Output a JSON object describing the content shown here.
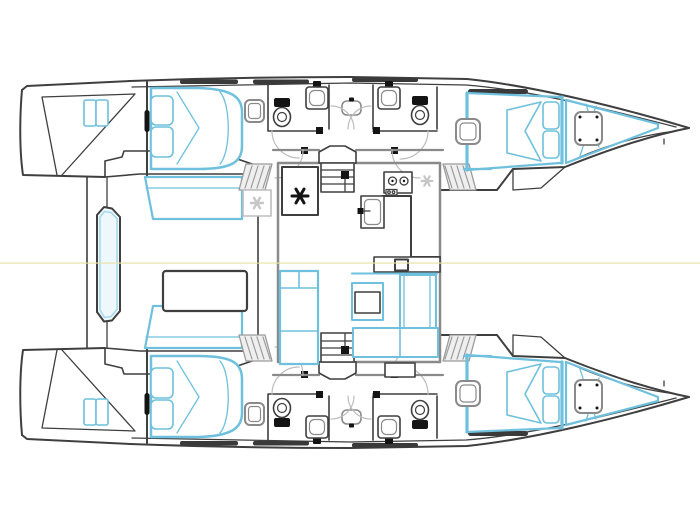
{
  "meta": {
    "title": "Catamaran interior layout floor plan",
    "view": "top-down deck plan",
    "orientation": "bows pointing right, sterns left",
    "symmetry": "port and starboard hulls mirrored about waterline centerline"
  },
  "colors": {
    "background": "#ffffff",
    "outline": "#3f3f3f",
    "wall-gray": "#8a8a8a",
    "light-gray": "#bdbdbd",
    "accent-blue": "#6fc0dc",
    "pale-blue-fill": "#eaf6fb",
    "hatch-gray": "#9a9a9a",
    "centerline-yellow": "#e8e2a8",
    "black-detail": "#141414",
    "window-dark": "#3a3a3a"
  },
  "layout": {
    "hull_count": 2,
    "cabin_double_beds": 2,
    "forward_berths": 2,
    "bow_v_berths": 2,
    "toilets": 4,
    "sinks": 4,
    "stove_burners": 2,
    "companionway_stairs": 2,
    "hatched_step_wells": 4
  },
  "components": [
    {
      "name": "aft-cabin-bed",
      "label": "Double berth with pillows and duvet"
    },
    {
      "name": "cabin-settee",
      "label": "Cabin settee / sofa"
    },
    {
      "name": "head-toilet",
      "label": "Marine toilet"
    },
    {
      "name": "head-sink",
      "label": "Washbasin with faucet"
    },
    {
      "name": "shower-stall",
      "label": "Central shower stall"
    },
    {
      "name": "galley",
      "label": "Galley with 2-burner stove, sink cabinet and counters"
    },
    {
      "name": "fridge",
      "label": "Refrigerator (black asterisk symbol)"
    },
    {
      "name": "cool-box",
      "label": "Cool box (light asterisk symbol)"
    },
    {
      "name": "companionway-stairs",
      "label": "Steps down into hull"
    },
    {
      "name": "nav-station",
      "label": "Chart / nav desk"
    },
    {
      "name": "dinette-table",
      "label": "Saloon dining table"
    },
    {
      "name": "dinette-settee",
      "label": "U-shaped saloon seating"
    },
    {
      "name": "coffee-table",
      "label": "Small saloon table"
    },
    {
      "name": "forward-berth",
      "label": "Forward cabin berth"
    },
    {
      "name": "bow-v-berth",
      "label": "Bow V-berth with deck hatch"
    },
    {
      "name": "porthole",
      "label": "Deck porthole / hatch"
    },
    {
      "name": "aft-bench",
      "label": "Aft cockpit bench between transoms"
    },
    {
      "name": "waterline-centerline",
      "label": "Yellow centerline"
    }
  ]
}
